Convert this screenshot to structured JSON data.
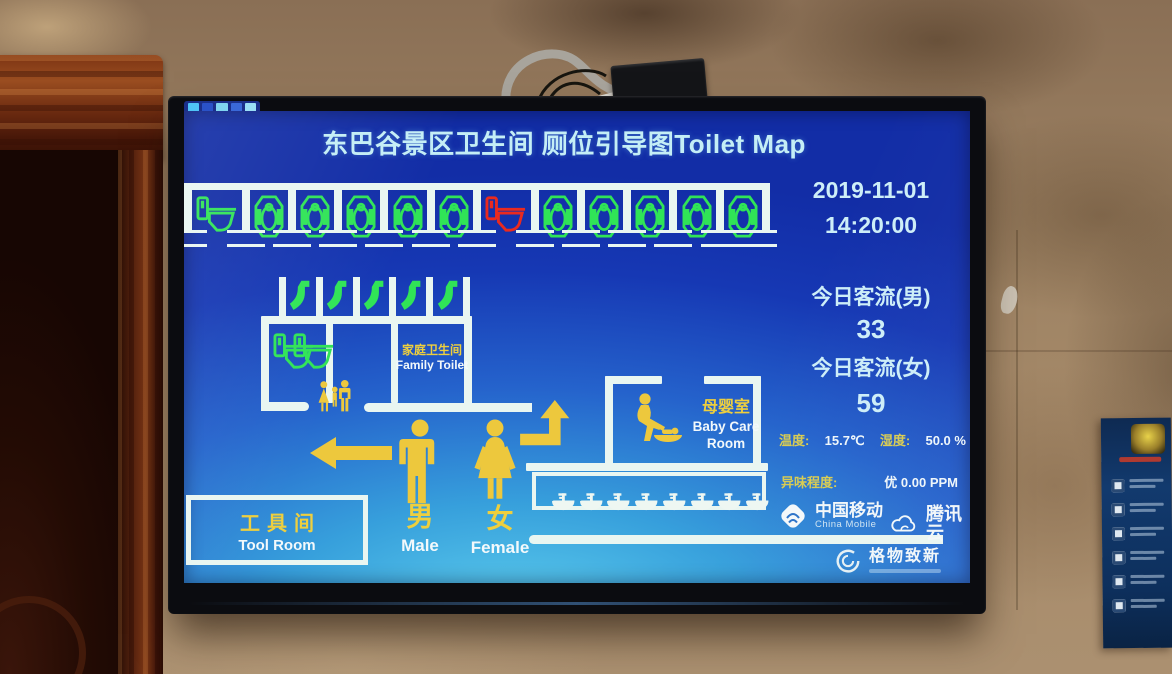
{
  "colors": {
    "wall_line": "#e9f6f1",
    "free_green": "#30e457",
    "occupied_red": "#ea2a1f",
    "accent_yellow": "#edc83d",
    "screen_blue": "#1e49c0"
  },
  "screen": {
    "title": "东巴谷景区卫生间 厕位引导图Toilet Map",
    "info": {
      "date": "2019-11-01",
      "time": "14:20:00",
      "male_flow_label": "今日客流(男)",
      "male_flow_value": "33",
      "female_flow_label": "今日客流(女)",
      "female_flow_value": "59",
      "temperature_label": "温度:",
      "temperature_value": "15.7℃",
      "humidity_label": "湿度:",
      "humidity_value": "50.0 %",
      "odor_label": "异味程度:",
      "odor_value": "优 0.00 PPM"
    },
    "map": {
      "rooms": {
        "family_toilet_zh": "家庭卫生间",
        "family_toilet_en": "Family Toilet",
        "baby_room_zh": "母婴室",
        "baby_room_en": "Baby Care Room",
        "tool_room_zh": "工具间",
        "tool_room_en": "Tool Room"
      },
      "male_zh": "男",
      "male_en": "Male",
      "female_zh": "女",
      "female_en": "Female",
      "stall_row_left": [
        {
          "type": "seat",
          "status": "free"
        },
        {
          "type": "squat",
          "status": "free"
        },
        {
          "type": "squat",
          "status": "free"
        },
        {
          "type": "squat",
          "status": "free"
        },
        {
          "type": "squat",
          "status": "free"
        },
        {
          "type": "squat",
          "status": "free"
        }
      ],
      "stall_row_right": [
        {
          "type": "seat",
          "status": "occupied"
        },
        {
          "type": "squat",
          "status": "free"
        },
        {
          "type": "squat",
          "status": "free"
        },
        {
          "type": "squat",
          "status": "free"
        },
        {
          "type": "squat",
          "status": "free"
        },
        {
          "type": "squat",
          "status": "free"
        }
      ],
      "urinals": [
        "free",
        "free",
        "free",
        "free",
        "free"
      ],
      "family_toilets": [
        "free",
        "free"
      ],
      "sink_count": 8
    },
    "logos": {
      "china_mobile_zh": "中国移动",
      "china_mobile_en": "China Mobile",
      "tencent_cloud": "腾讯云",
      "gewu_zhixin": "格物致新"
    }
  }
}
